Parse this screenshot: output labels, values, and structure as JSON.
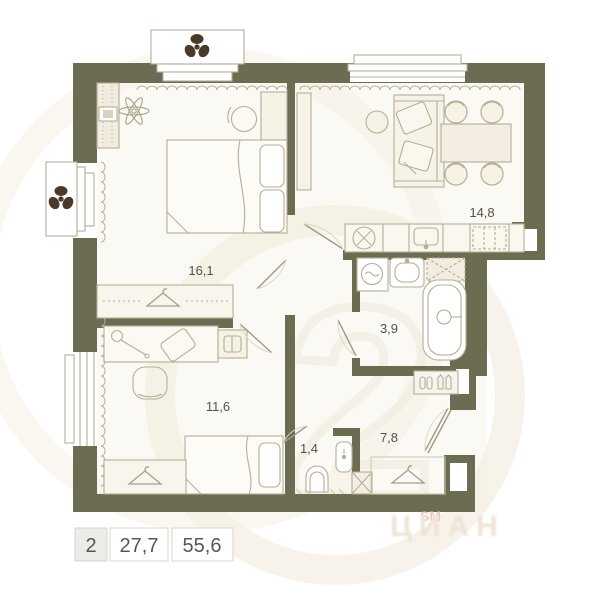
{
  "plan_title": "apartment-floor-plan",
  "rooms": [
    {
      "name": "bedroom-1",
      "area": "16,1"
    },
    {
      "name": "kitchen-living-room",
      "area": "14,8"
    },
    {
      "name": "bathroom",
      "area": "3,9"
    },
    {
      "name": "bedroom-2",
      "area": "11,6"
    },
    {
      "name": "wc",
      "area": "1,4"
    },
    {
      "name": "hallway",
      "area": "7,8"
    }
  ],
  "legend": {
    "rooms_count": "2",
    "living_area": "27,7",
    "total_area": "55,6"
  },
  "watermark": {
    "sm": "SM",
    "brand": "ЦИАН",
    "big_digit": "2"
  },
  "icons": [
    "fan-icon",
    "plant-icon",
    "hanger-icon",
    "bed-icon",
    "pillow-icon",
    "sofa-icon",
    "dining-table-icon",
    "chair-icon",
    "pouf-icon",
    "desk-icon",
    "lamp-icon",
    "laptop-icon",
    "dresser-icon",
    "tv-icon",
    "sink-icon",
    "hob-icon",
    "stove-icon",
    "washing-machine-icon",
    "bathtub-icon",
    "toilet-icon",
    "shoe-shelf-icon",
    "radiator-icon",
    "curtain-icon",
    "door-icon",
    "window-icon",
    "shaft-icon"
  ],
  "colors": {
    "wall": "#6c6c53",
    "floor": "#fbf9f3",
    "outline": "#b5ad97",
    "furniture_fill": "#f4efe2",
    "fan": "#4a3a28",
    "label": "#55504a",
    "watermark_cream": "#f1ebdc",
    "watermark_pink": "#f0c9ba",
    "legend_border": "#d9d5ca",
    "legend_cell_bg": "#ebebe8"
  }
}
